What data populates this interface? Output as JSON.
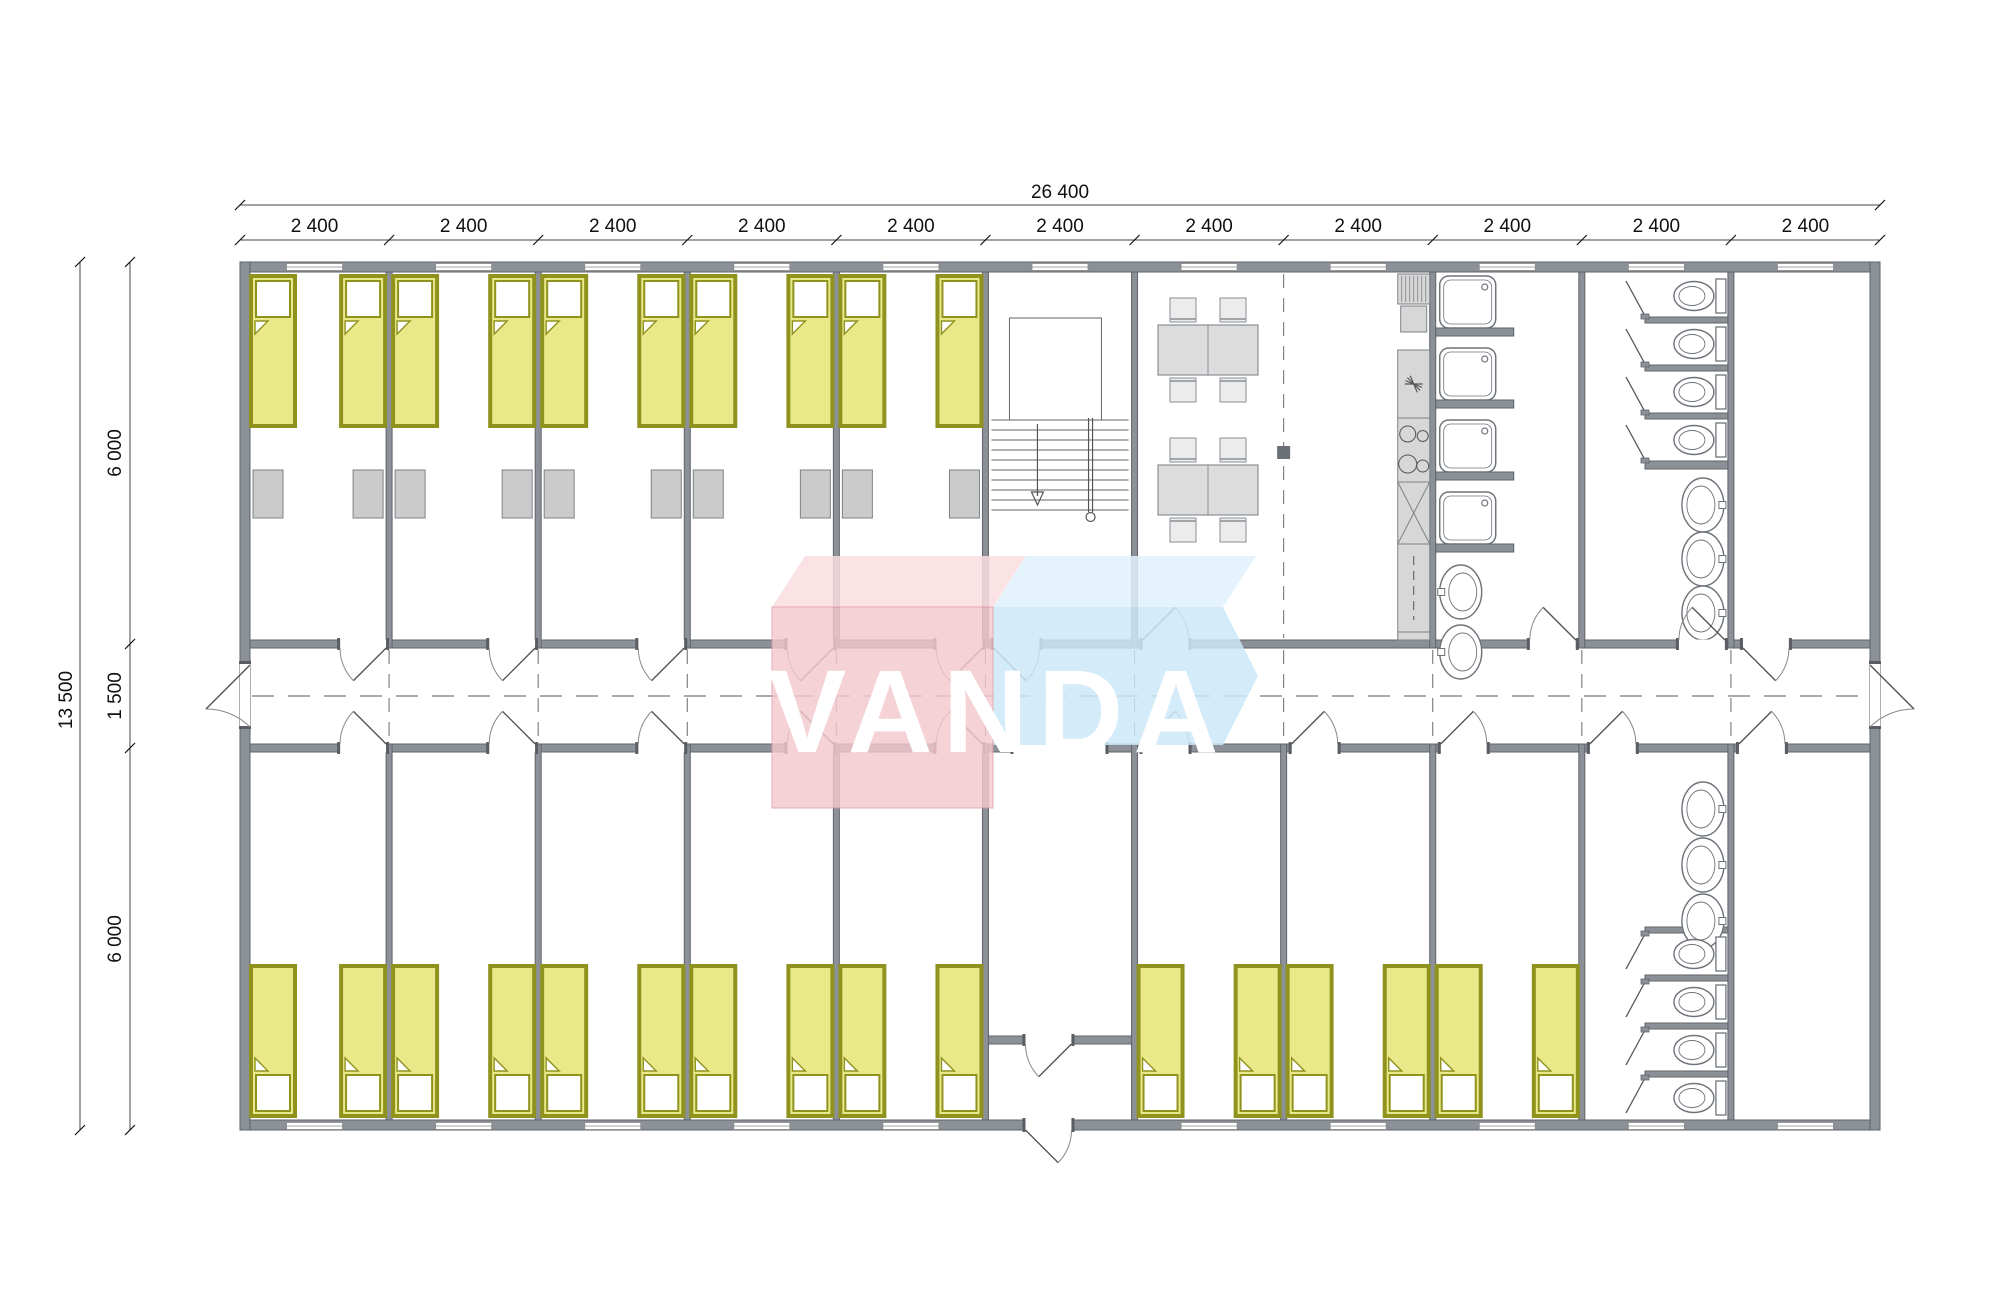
{
  "watermark": {
    "text": "VANDA"
  },
  "dimensions": {
    "total_width_label": "26 400",
    "module_width_label": "2 400",
    "module_count": 11,
    "total_height_label": "13 500",
    "left_segment_labels": [
      "6 000",
      "1 500",
      "6 000"
    ]
  },
  "plan": {
    "bedrooms_top": 5,
    "bedrooms_bottom": 8,
    "beds_top": 10,
    "beds_bottom": 16,
    "wardrobes": 10,
    "dining_tables": 2,
    "chairs_per_table": 4,
    "shower_cabins": 4,
    "toilets": 8,
    "wash_basins": 8,
    "stairs": 1,
    "entrance_vestibule": 1
  },
  "colors": {
    "wall": "#8c9097",
    "wall_stroke": "#5f646b",
    "bed_fill": "#e9e98a",
    "bed_border": "#8f921d",
    "wardrobe": "#cbcbcb",
    "furniture": "#dcdcdc",
    "fixture_stroke": "#6f747a",
    "dash": "#777777",
    "dim": "#1a1a1a",
    "logo_pink": "#f4c9ce",
    "logo_pink_top": "#f9dde0",
    "logo_pink_stroke": "#e09aa6",
    "logo_blue": "#cde7f8",
    "logo_blue_top": "#e0f1fb",
    "logo_text": "#ffffff"
  }
}
